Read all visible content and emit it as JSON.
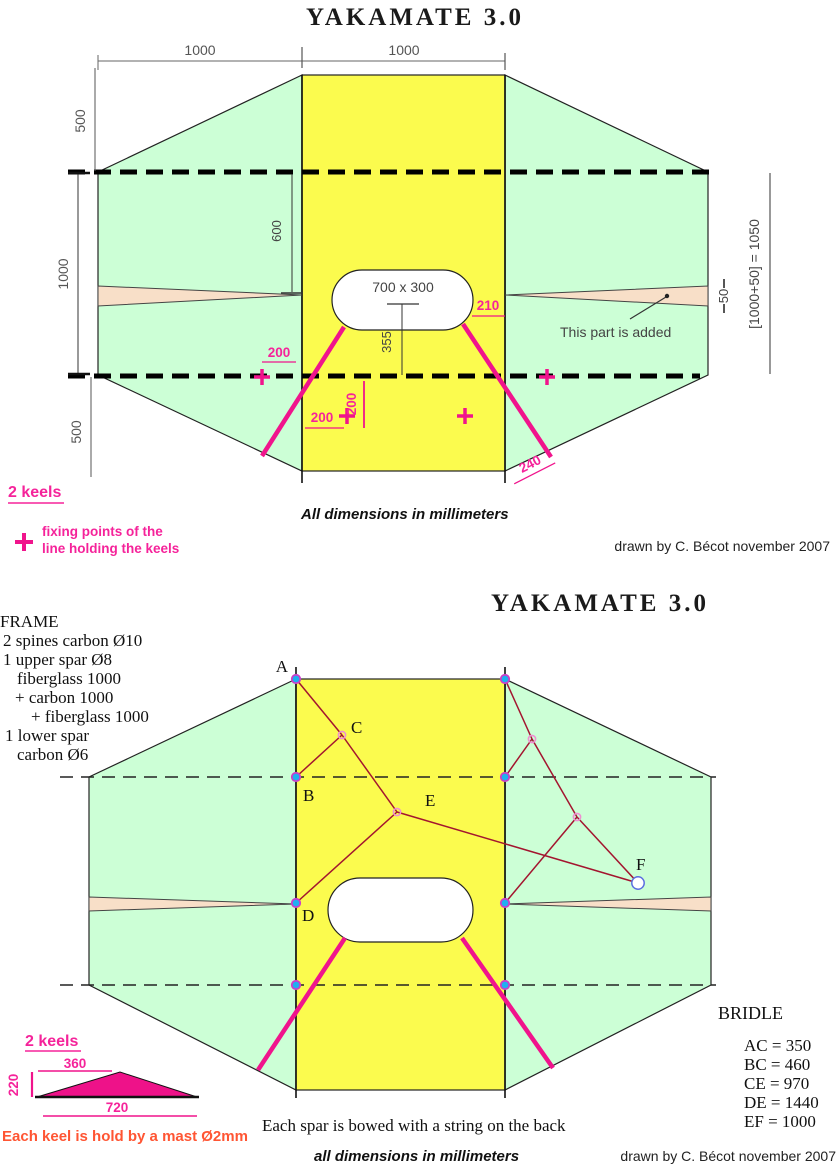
{
  "colors": {
    "sail_green": "#ccffd6",
    "sail_yellow": "#fbfb4e",
    "added_peach": "#f8dfc8",
    "keel_magenta": "#f0148c",
    "keel_fill": "#ee1289",
    "bridle_red": "#a3152f",
    "dot_cyan": "#1fb0f0",
    "dot_ring": "#c93fc9",
    "note_orange": "#ff5533"
  },
  "top": {
    "title": "YAKAMATE 3.0",
    "credit": "drawn by C. Bécot november 2007",
    "units_note": "All dimensions in millimeters",
    "keels_label": "2 keels",
    "legend_line1": "fixing points of the",
    "legend_line2": "line holding the keels",
    "added_note": "This part is added",
    "dims": {
      "span_left": "1000",
      "span_center": "1000",
      "left_upper": "500",
      "left_mid": "1000",
      "left_lower": "500",
      "spar_offset": "600",
      "hole_size": "700 x 300",
      "hole_to_line": "355",
      "keel_right_top": "210",
      "keel_left_top": "200",
      "keel_left_bottom": "200",
      "keel_left_vert": "200",
      "keel_right_bottom": "240",
      "added_height": "50",
      "right_total": "[1000+50] = 1050"
    }
  },
  "bottom": {
    "title": "YAKAMATE 3.0",
    "frame_lines": [
      "FRAME",
      "2 spines carbon Ø10",
      "1 upper spar Ø8",
      "fiberglass 1000",
      "+ carbon 1000",
      "+ fiberglass 1000",
      "1 lower spar",
      "carbon Ø6"
    ],
    "point_labels": {
      "a": "A",
      "b": "B",
      "c": "C",
      "d": "D",
      "e": "E",
      "f": "F"
    },
    "bridle_title": "BRIDLE",
    "bridle_items": [
      "AC = 350",
      "BC = 460",
      "CE = 970",
      "DE = 1440",
      "EF = 1000"
    ],
    "keels_label": "2 keels",
    "keel_dims": {
      "upper": "360",
      "height": "220",
      "base": "720"
    },
    "keel_note": "Each keel is hold by a mast Ø2mm",
    "spar_note": "Each spar is bowed with a string on the back",
    "units_note": "all dimensions in millimeters",
    "credit": "drawn by C. Bécot november 2007"
  }
}
